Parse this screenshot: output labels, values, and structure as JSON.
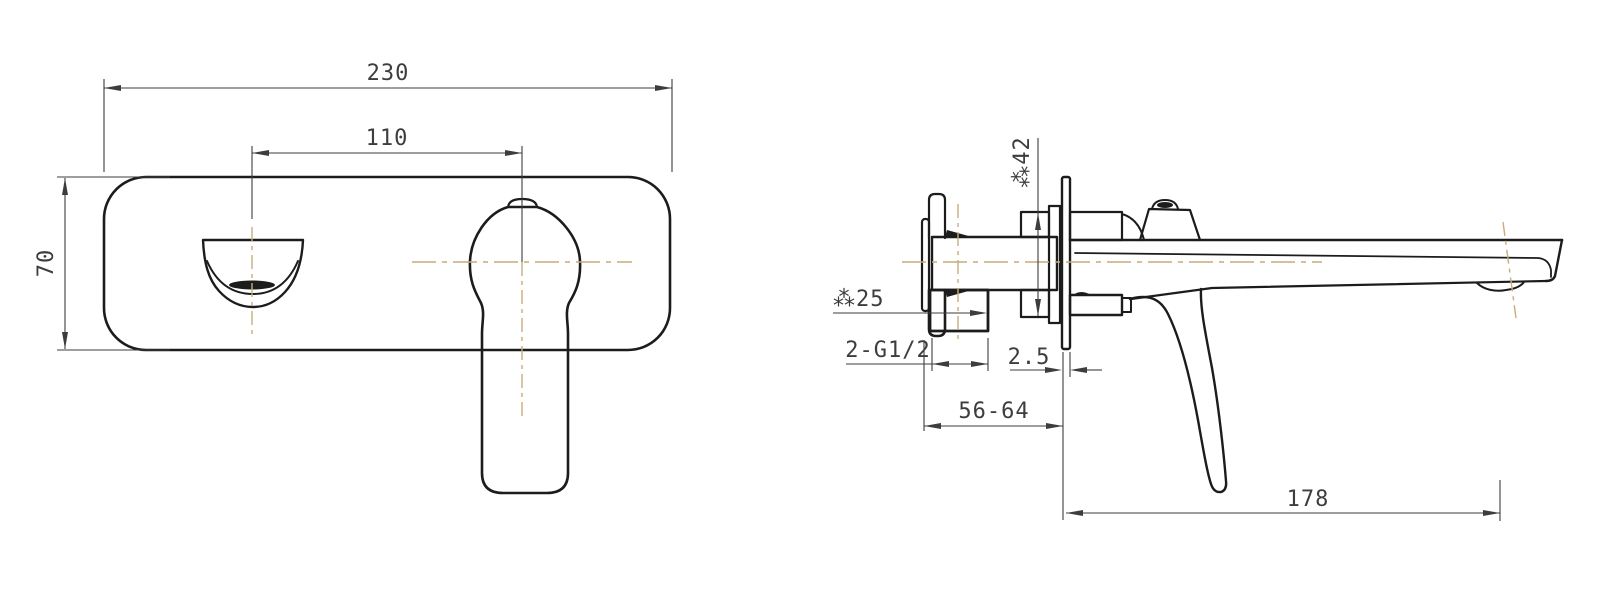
{
  "colors": {
    "line": "#1c1c1c",
    "dim": "#3d3d3d",
    "centerline": "#c9ac7c",
    "background": "#ffffff"
  },
  "dims": {
    "front_width": "230",
    "front_spout_to_handle": "110",
    "front_height": "70",
    "side_trim_diameter": "⁂42",
    "side_inlet_diameter": "⁂25",
    "side_thread_spec": "2-G1/2",
    "side_plate_thickness": "2.5",
    "side_rough_in_depth": "56-64",
    "side_spout_reach": "178"
  }
}
